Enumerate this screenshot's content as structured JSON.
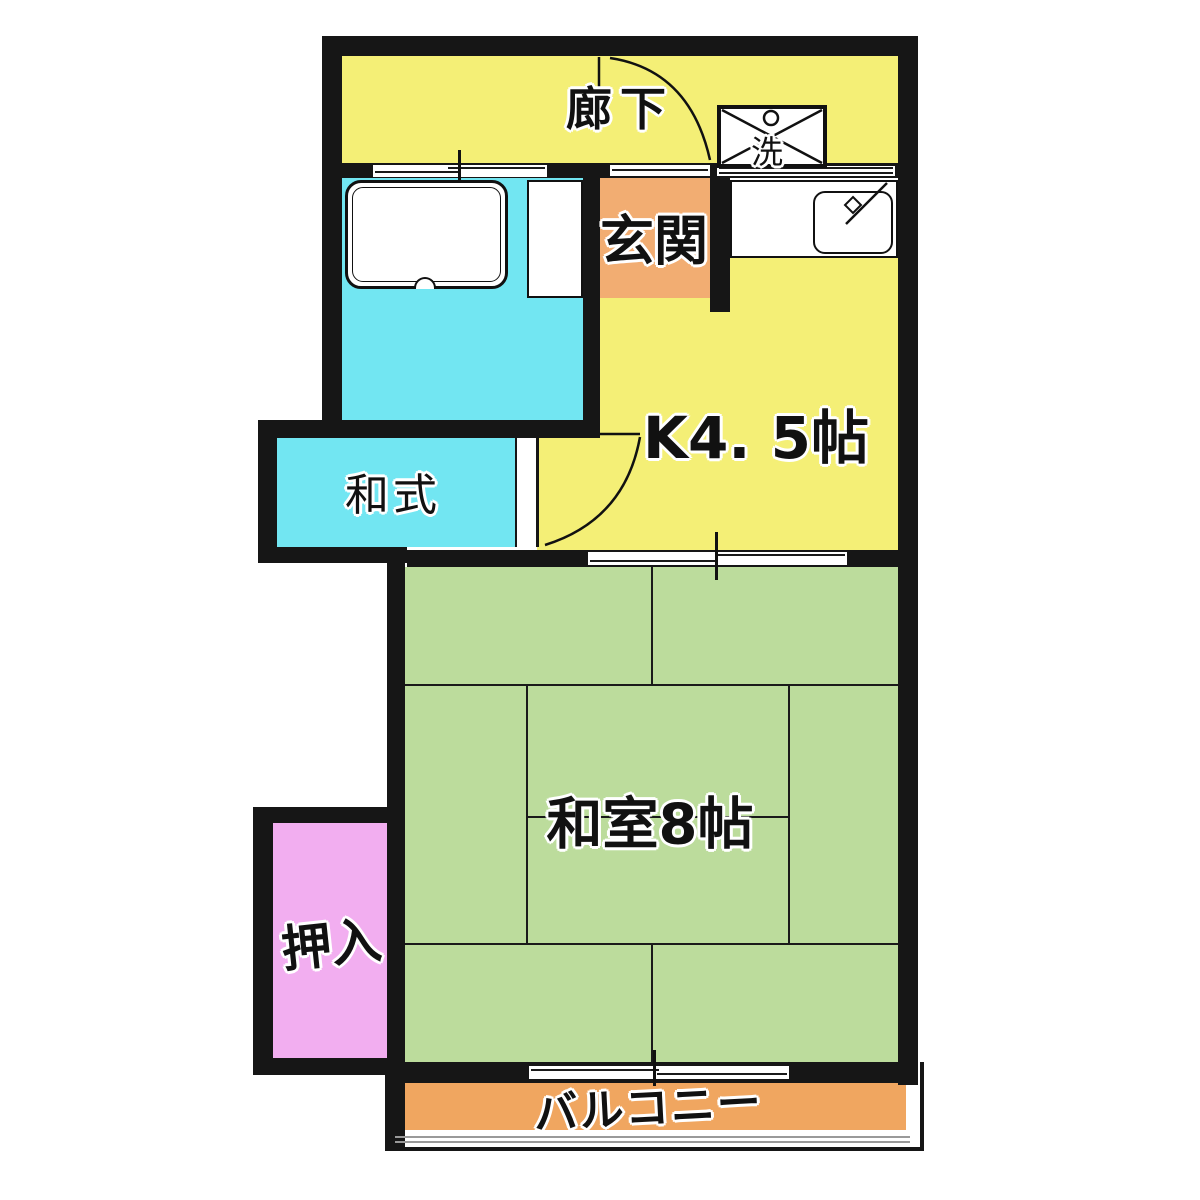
{
  "floorplan": {
    "colors": {
      "wall": "#161616",
      "corridor_yellow": "#F4EF76",
      "entrance_orange": "#F2AD72",
      "toilet_cyan": "#72E6F2",
      "tatami_green": "#BCDC9C",
      "closet_pink": "#F2AEF0",
      "balcony_orange": "#F0A660",
      "fixture_white": "#FFFFFF"
    },
    "rooms": {
      "corridor": {
        "label": "廊下"
      },
      "entrance": {
        "label": "玄関"
      },
      "kitchen": {
        "label": "K4. 5帖",
        "size_tatami": "4.5"
      },
      "toilet": {
        "label": "和式"
      },
      "tatami_room": {
        "label": "和室8帖",
        "size_tatami": "8"
      },
      "closet": {
        "label": "押入"
      },
      "balcony": {
        "label": "バルコニー"
      }
    },
    "fixtures": {
      "washing_machine": {
        "label": "洗"
      }
    }
  }
}
